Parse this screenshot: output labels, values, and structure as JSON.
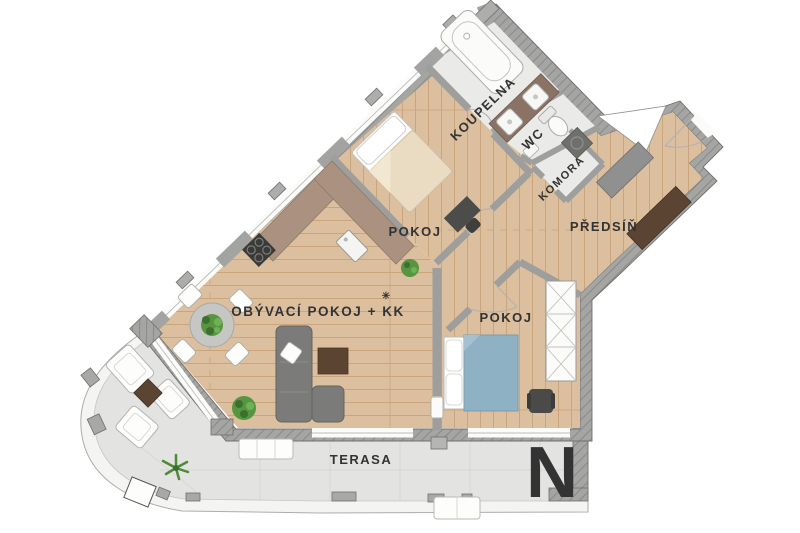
{
  "plan_type": "apartment-floor-plan",
  "rooms": {
    "koupelna": {
      "label": "KOUPELNA",
      "rotation_deg": -44
    },
    "wc": {
      "label": "WC",
      "rotation_deg": -44
    },
    "komora": {
      "label": "KOMORA",
      "rotation_deg": -44
    },
    "predsin": {
      "label": "PŘEDSÍŇ",
      "rotation_deg": 0
    },
    "pokoj_horni": {
      "label": "POKOJ",
      "rotation_deg": 0
    },
    "pokoj_dolni": {
      "label": "POKOJ",
      "rotation_deg": 0
    },
    "obyvaci_pokoj": {
      "label": "OBÝVACÍ POKOJ + KK",
      "rotation_deg": 0
    },
    "terasa": {
      "label": "TERASA",
      "rotation_deg": 0
    }
  },
  "symbols": {
    "fridge": "✳"
  },
  "watermark": {
    "text": "N"
  },
  "furniture_icons": [
    "bathtub",
    "double-washbasin",
    "toilet",
    "hand-basin",
    "washing-machine",
    "kitchen-counter",
    "cooktop",
    "kitchen-sink",
    "dining-table",
    "dining-chair",
    "table-plant",
    "sofa",
    "sofa-pillow",
    "coffee-table",
    "floor-plant",
    "bed",
    "desk",
    "desk-chair",
    "wardrobe",
    "hallway-sideboard",
    "hallway-cabinet",
    "entry-door",
    "lounge-chair",
    "side-table",
    "terrace-bench",
    "palm-plant"
  ],
  "colors": {
    "wood_floor": "#dcbf9e",
    "wall_gray": "#a5a5a3",
    "tile_floor": "#eaeae8",
    "terrace_floor": "#e3e3e1",
    "railing_white": "#f4f4f3",
    "kitchen_counter": "#ab9280",
    "dark_furniture": "#5c4433",
    "sofa_gray": "#7b7b79",
    "bed_blue": "#8fb1c4",
    "bed_beige": "#eadcc2",
    "plant_green": "#579540",
    "label_text": "#333333"
  }
}
